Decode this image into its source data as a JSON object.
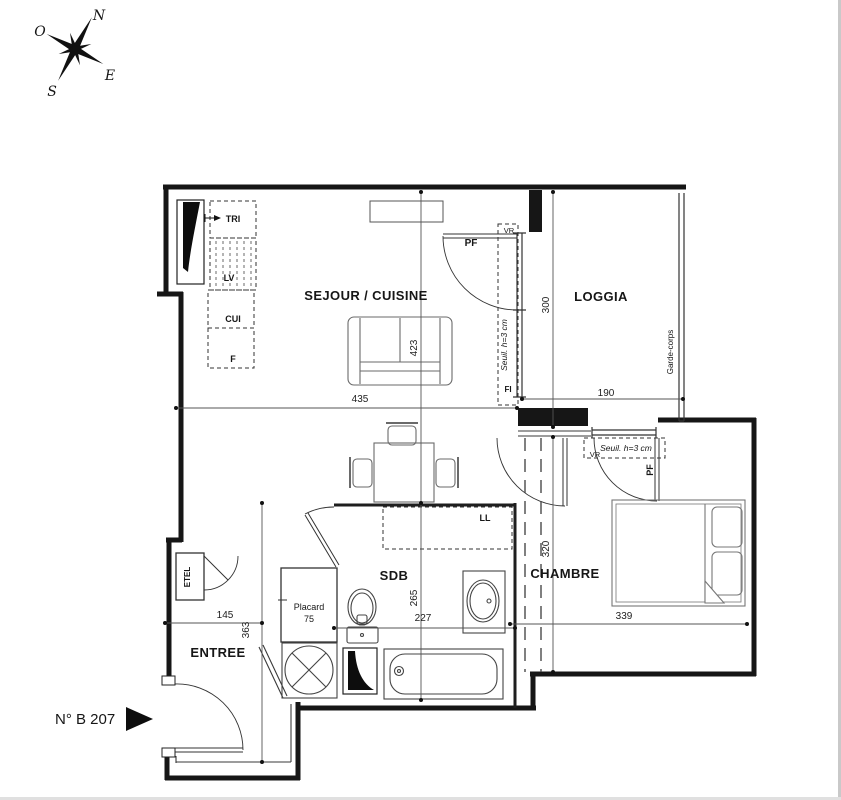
{
  "page": {
    "unit_number": "N° B 207"
  },
  "compass": {
    "north": "N",
    "west": "O",
    "east": "E",
    "south": "S"
  },
  "rooms": {
    "sejour_cuisine": "SEJOUR / CUISINE",
    "loggia": "LOGGIA",
    "chambre": "CHAMBRE",
    "sdb": "SDB",
    "entree": "ENTREE"
  },
  "kitchen": {
    "tri": "TRI",
    "lv": "LV",
    "cui": "CUI",
    "f": "F"
  },
  "fixtures": {
    "ll": "LL",
    "etel": "ETEL",
    "placard": "Placard",
    "placard_width": "75",
    "garde_corps": "Garde-corps"
  },
  "openings": {
    "sejour_window": {
      "pf": "PF",
      "vr": "VR",
      "fi": "FI",
      "seuil": "Seuil. h=3 cm"
    },
    "chambre_window": {
      "pf": "PF",
      "vr": "VR",
      "seuil": "Seuil. h=3 cm"
    }
  },
  "dimensions_cm": {
    "sejour_width": "435",
    "sejour_height": "423",
    "loggia_height": "300",
    "loggia_width": "190",
    "chambre_height": "320",
    "chambre_width": "339",
    "sdb_height": "265",
    "sdb_width": "227",
    "entree_width": "145",
    "entree_height": "363"
  },
  "colors": {
    "wall": "#161616",
    "thin_line": "#3a3a3a",
    "furniture": "#6a6a6a"
  }
}
